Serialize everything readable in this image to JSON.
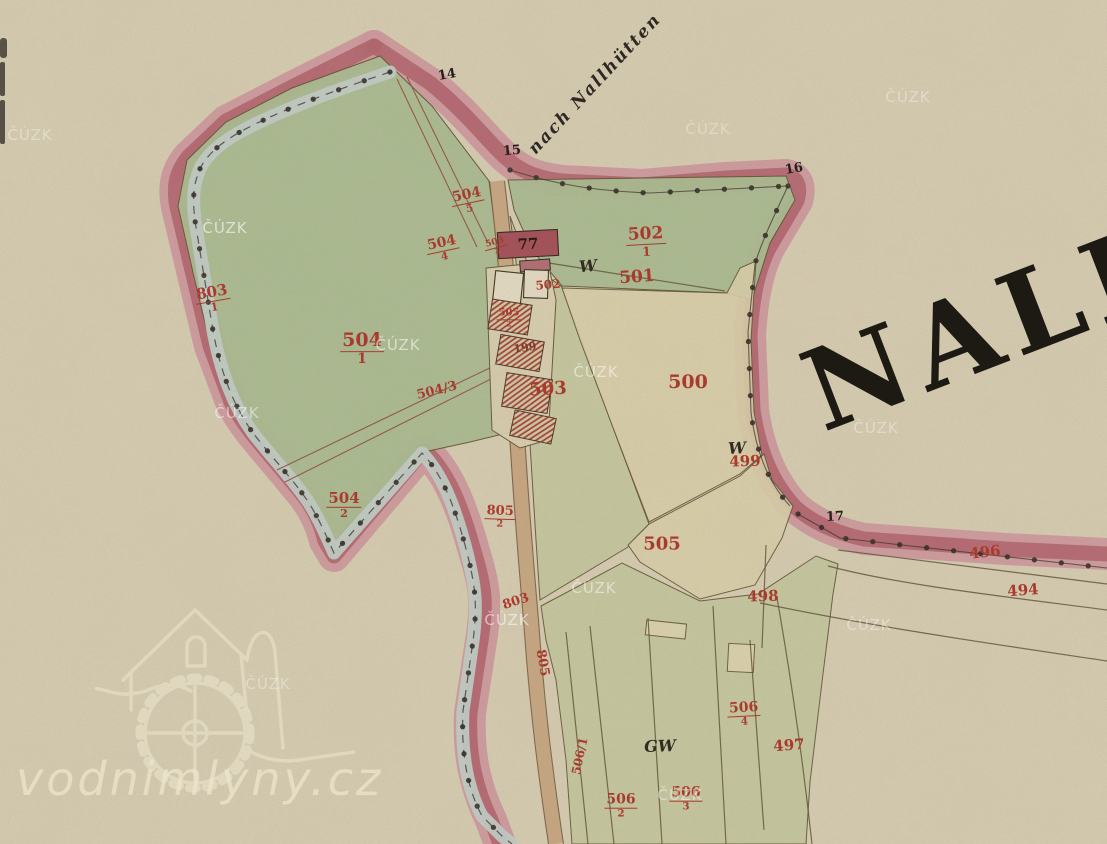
{
  "page": {
    "width": 1107,
    "height": 844
  },
  "map": {
    "region_name_text": "NALL",
    "path_label_text": "nach Nallhütten",
    "house_number_text": "77",
    "boundary_point_labels": [
      {
        "text": "14",
        "x": 447,
        "y": 75,
        "rot": -10
      },
      {
        "text": "15",
        "x": 512,
        "y": 151,
        "rot": -5
      },
      {
        "text": "16",
        "x": 794,
        "y": 169,
        "rot": -10
      },
      {
        "text": "17",
        "x": 835,
        "y": 517,
        "rot": -3
      }
    ],
    "meadow_symbols": [
      {
        "text": "W",
        "x": 588,
        "y": 266,
        "rot": -5
      },
      {
        "text": "W",
        "x": 737,
        "y": 448,
        "rot": -3
      },
      {
        "text": "GW",
        "x": 660,
        "y": 746,
        "rot": -2
      }
    ],
    "parcel_labels": [
      {
        "num": "803",
        "den": "1",
        "x": 213,
        "y": 299,
        "rot": -10,
        "size": 15
      },
      {
        "num": "504",
        "den": "1",
        "x": 362,
        "y": 349,
        "rot": 0,
        "size": 19
      },
      {
        "num": "504",
        "den": "5",
        "x": 468,
        "y": 201,
        "rot": -12,
        "size": 14
      },
      {
        "num": "504",
        "den": "4",
        "x": 443,
        "y": 249,
        "rot": -12,
        "size": 14
      },
      {
        "num": "504",
        "den": "2",
        "x": 344,
        "y": 505,
        "rot": 0,
        "size": 15
      },
      {
        "num": "502",
        "den": "1",
        "x": 646,
        "y": 242,
        "rot": -3,
        "size": 17
      },
      {
        "num": "805",
        "den": "2",
        "x": 500,
        "y": 517,
        "rot": 2,
        "size": 13
      },
      {
        "num": "503",
        "den": "2",
        "x": 496,
        "y": 247,
        "rot": -15,
        "size": 9
      },
      {
        "num": "505",
        "den": "2",
        "x": 509,
        "y": 318,
        "rot": 0,
        "size": 10
      },
      {
        "num": "506",
        "den": "4",
        "x": 744,
        "y": 714,
        "rot": -3,
        "size": 14
      },
      {
        "num": "506",
        "den": "3",
        "x": 686,
        "y": 799,
        "rot": 0,
        "size": 14
      },
      {
        "num": "506",
        "den": "2",
        "x": 621,
        "y": 806,
        "rot": 0,
        "size": 14
      },
      {
        "text": "504/3",
        "x": 437,
        "y": 391,
        "rot": -14,
        "size": 13
      },
      {
        "text": "501",
        "x": 637,
        "y": 278,
        "rot": -4,
        "size": 17
      },
      {
        "text": "500",
        "x": 688,
        "y": 383,
        "rot": 0,
        "size": 19
      },
      {
        "text": "499",
        "x": 745,
        "y": 462,
        "rot": -2,
        "size": 15
      },
      {
        "text": "505",
        "x": 662,
        "y": 545,
        "rot": 0,
        "size": 18
      },
      {
        "text": "503",
        "x": 548,
        "y": 390,
        "rot": -3,
        "size": 18
      },
      {
        "text": "502",
        "x": 548,
        "y": 285,
        "rot": -5,
        "size": 12
      },
      {
        "text": "199",
        "x": 525,
        "y": 348,
        "rot": -8,
        "size": 11,
        "dark": true
      },
      {
        "text": "498",
        "x": 763,
        "y": 597,
        "rot": -2,
        "size": 15
      },
      {
        "text": "496",
        "x": 985,
        "y": 553,
        "rot": -6,
        "size": 15
      },
      {
        "text": "494",
        "x": 1023,
        "y": 591,
        "rot": -4,
        "size": 15
      },
      {
        "text": "497",
        "x": 789,
        "y": 746,
        "rot": -4,
        "size": 15
      },
      {
        "text": "803",
        "x": 516,
        "y": 602,
        "rot": -18,
        "size": 13
      },
      {
        "text": "805",
        "x": 542,
        "y": 663,
        "rot": 80,
        "size": 13
      },
      {
        "text": "506/1",
        "x": 580,
        "y": 756,
        "rot": -78,
        "size": 12
      }
    ]
  },
  "watermarks": {
    "cuzk_text": "ČÚZK",
    "cuzk_positions": [
      {
        "x": 225,
        "y": 228,
        "op": 0.6
      },
      {
        "x": 30,
        "y": 135,
        "op": 0.35
      },
      {
        "x": 398,
        "y": 345,
        "op": 0.55
      },
      {
        "x": 237,
        "y": 413,
        "op": 0.5
      },
      {
        "x": 596,
        "y": 372,
        "op": 0.5
      },
      {
        "x": 594,
        "y": 588,
        "op": 0.5
      },
      {
        "x": 507,
        "y": 620,
        "op": 0.55
      },
      {
        "x": 876,
        "y": 428,
        "op": 0.35
      },
      {
        "x": 869,
        "y": 625,
        "op": 0.4
      },
      {
        "x": 708,
        "y": 129,
        "op": 0.3
      },
      {
        "x": 908,
        "y": 97,
        "op": 0.35
      },
      {
        "x": 680,
        "y": 795,
        "op": 0.45
      },
      {
        "x": 268,
        "y": 684,
        "op": 0.35
      }
    ],
    "site_text": "vodnimlyny.cz"
  },
  "colors": {
    "paper": "#d9cfb4",
    "band_light": "#d1989f",
    "band_core": "#b2606c",
    "pond": "#abbd92",
    "field_green": "#c6c9a0",
    "field_light": "#ddd2ac",
    "strip": "#c3cfc9",
    "road": "#c8a480",
    "building": "#a34b55",
    "building_light": "#b06a72",
    "hatch_red": "#9c3f31",
    "red": "#a93b2e",
    "red_dark": "#7e3a2b",
    "ink": "#2c2620",
    "line_olive": "#5d5132",
    "line_redbrown": "#8d4a3c",
    "white_bldg": "#e6ddc6",
    "wm": "#ffffff",
    "site": "#efe7cd"
  }
}
